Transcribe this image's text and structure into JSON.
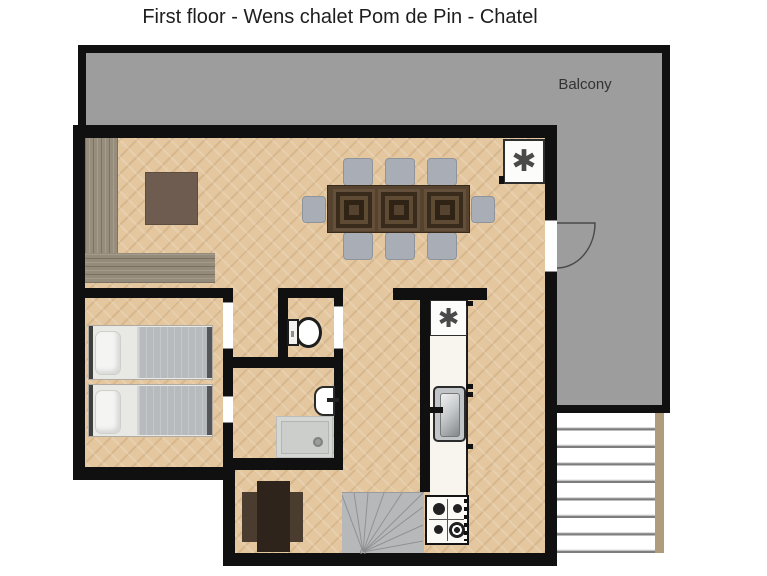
{
  "title": "First floor - Wens chalet Pom de Pin - Chatel",
  "balcony": {
    "label": "Balcony"
  },
  "symbols": {
    "living_stove": "✱",
    "kitchen_appliance": "✱"
  },
  "colors": {
    "wall": "#101010",
    "balcony": "#9d9d9d",
    "floor": "#e4c79f",
    "counter": "#f8f5ee",
    "stair": "#b6b8ba"
  }
}
